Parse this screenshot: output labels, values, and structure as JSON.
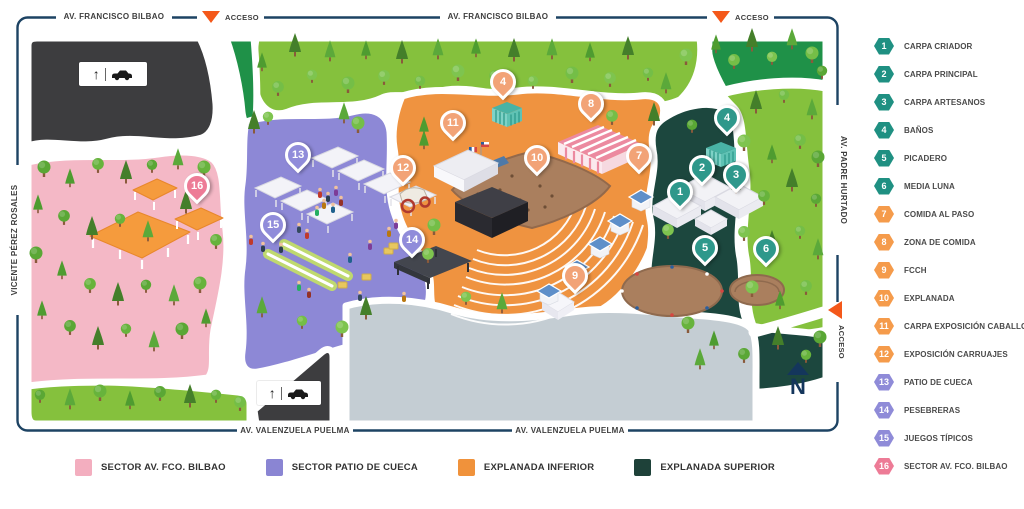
{
  "map": {
    "streets": {
      "top_left": "AV. FRANCISCO BILBAO",
      "top_right": "AV. FRANCISCO BILBAO",
      "bottom_left": "AV. VALENZUELA PUELMA",
      "bottom_right": "AV. VALENZUELA PUELMA",
      "left": "VICENTE PÉREZ ROSALES",
      "right": "AV. PADRE HURTADO"
    },
    "access_labels": [
      {
        "position": "top-left",
        "label": "ACCESO"
      },
      {
        "position": "top-right",
        "label": "ACCESO"
      },
      {
        "position": "right",
        "label": "ACCESO"
      }
    ],
    "access_color": "#F4581A",
    "north_label": "N",
    "pin_palette": {
      "teal": "#2E988B",
      "orange": "#F2A377",
      "purple": "#908CDA",
      "pink": "#ED7B96"
    },
    "pins": [
      {
        "number": "1",
        "x": 680,
        "y": 195,
        "palette": "teal"
      },
      {
        "number": "2",
        "x": 702,
        "y": 171,
        "palette": "teal"
      },
      {
        "number": "3",
        "x": 736,
        "y": 178,
        "palette": "teal"
      },
      {
        "number": "4",
        "x": 727,
        "y": 121,
        "palette": "teal"
      },
      {
        "number": "4",
        "x": 503,
        "y": 85,
        "palette": "orange"
      },
      {
        "number": "5",
        "x": 705,
        "y": 251,
        "palette": "teal"
      },
      {
        "number": "6",
        "x": 766,
        "y": 252,
        "palette": "teal"
      },
      {
        "number": "7",
        "x": 639,
        "y": 159,
        "palette": "orange"
      },
      {
        "number": "8",
        "x": 591,
        "y": 107,
        "palette": "orange"
      },
      {
        "number": "9",
        "x": 575,
        "y": 279,
        "palette": "orange"
      },
      {
        "number": "10",
        "x": 537,
        "y": 161,
        "palette": "orange"
      },
      {
        "number": "11",
        "x": 453,
        "y": 126,
        "palette": "orange"
      },
      {
        "number": "12",
        "x": 403,
        "y": 171,
        "palette": "orange"
      },
      {
        "number": "13",
        "x": 298,
        "y": 158,
        "palette": "purple"
      },
      {
        "number": "14",
        "x": 412,
        "y": 243,
        "palette": "purple"
      },
      {
        "number": "15",
        "x": 273,
        "y": 228,
        "palette": "purple"
      },
      {
        "number": "16",
        "x": 197,
        "y": 189,
        "palette": "pink"
      }
    ]
  },
  "legend": {
    "items": [
      {
        "number": "1",
        "label": "CARPA CRIADOR",
        "color": "#1F9082"
      },
      {
        "number": "2",
        "label": "CARPA PRINCIPAL",
        "color": "#1F9082"
      },
      {
        "number": "3",
        "label": "CARPA ARTESANOS",
        "color": "#1F9082"
      },
      {
        "number": "4",
        "label": "BAÑOS",
        "color": "#1F9082"
      },
      {
        "number": "5",
        "label": "PICADERO",
        "color": "#1F9082"
      },
      {
        "number": "6",
        "label": "MEDIA LUNA",
        "color": "#1F9082"
      },
      {
        "number": "7",
        "label": "COMIDA AL PASO",
        "color": "#F59B4B"
      },
      {
        "number": "8",
        "label": "ZONA DE COMIDA",
        "color": "#F59B4B"
      },
      {
        "number": "9",
        "label": "FCCH",
        "color": "#F59B4B"
      },
      {
        "number": "10",
        "label": "EXPLANADA",
        "color": "#F59B4B"
      },
      {
        "number": "11",
        "label": "CARPA EXPOSICIÓN CABALLOS",
        "color": "#F59B4B"
      },
      {
        "number": "12",
        "label": "EXPOSICIÓN CARRUAJES",
        "color": "#F59B4B"
      },
      {
        "number": "13",
        "label": "PATIO DE CUECA",
        "color": "#8F8BD8"
      },
      {
        "number": "14",
        "label": "PESEBRERAS",
        "color": "#8F8BD8"
      },
      {
        "number": "15",
        "label": "JUEGOS TÍPICOS",
        "color": "#8F8BD8"
      },
      {
        "number": "16",
        "label": "SECTOR AV. FCO. BILBAO",
        "color": "#ED7B96"
      }
    ]
  },
  "sector_legend": [
    {
      "label": "SECTOR AV. FCO. BILBAO",
      "color": "#F3AEBF"
    },
    {
      "label": "SECTOR PATIO DE CUECA",
      "color": "#8A85D3"
    },
    {
      "label": "EXPLANADA INFERIOR",
      "color": "#F0923B"
    },
    {
      "label": "EXPLANADA SUPERIOR",
      "color": "#1E4139"
    }
  ]
}
